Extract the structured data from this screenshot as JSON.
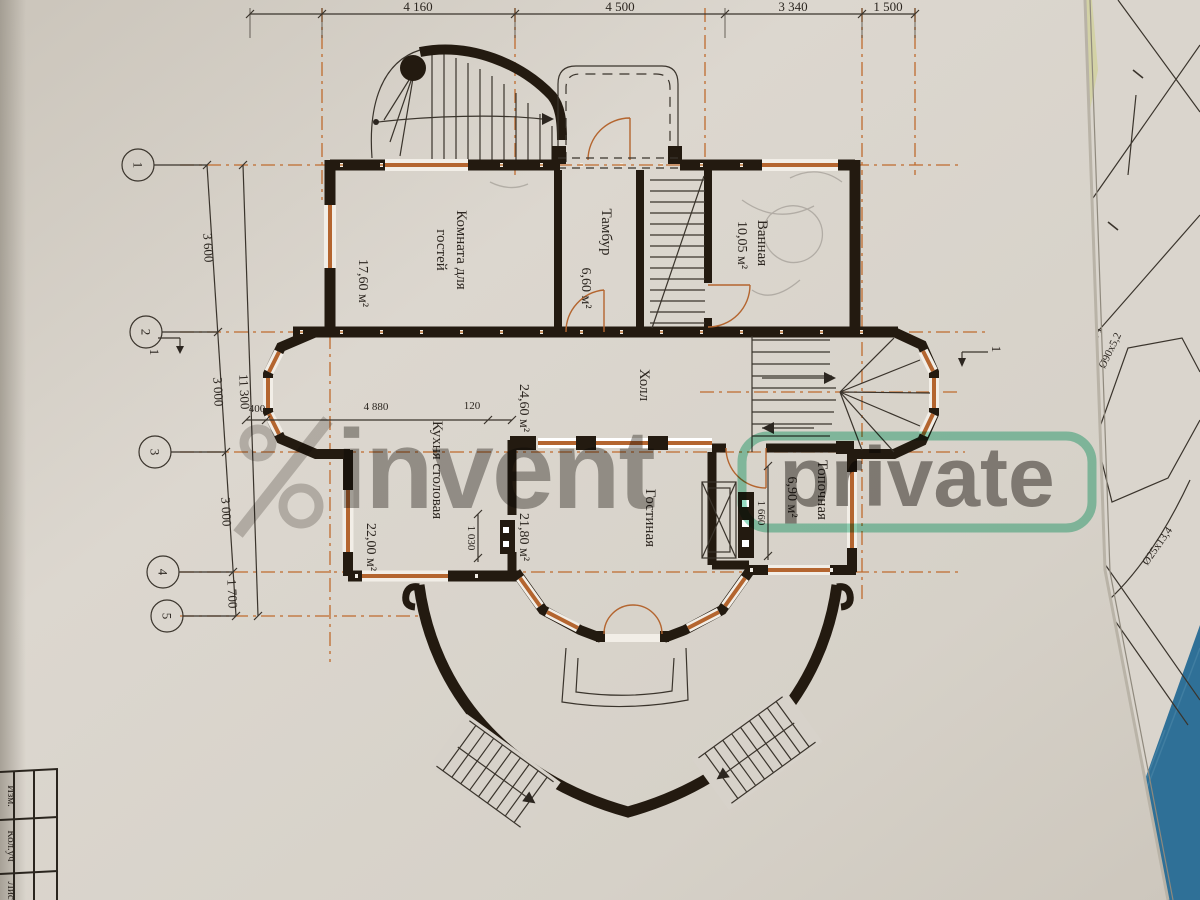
{
  "watermark": {
    "brand": "invent",
    "badge": "private"
  },
  "title_block": {
    "row1": "Изм.",
    "row2": "Кол.уч",
    "row3": "Лист"
  },
  "side_sheet": {
    "pipe1_tag": "Г1",
    "pipe1_size": "Ø90x5,2",
    "pipe2_size": "Ø25x13,4"
  },
  "plan": {
    "grid": {
      "a1": "1",
      "a2": "2",
      "a3": "3",
      "a4": "4",
      "a5": "5"
    },
    "sections": {
      "left": "1",
      "right": "1"
    },
    "rooms": {
      "guest": {
        "line1": "Комната для",
        "line2": "гостей",
        "area": "17,60 м²"
      },
      "tambour": {
        "name": "Тамбур",
        "area": "6,60 м²"
      },
      "bath": {
        "name": "Ванная",
        "area": "10,05 м²"
      },
      "hall": {
        "name": "Холл",
        "area": "24,60 м²"
      },
      "kitchen": {
        "name": "Кухня столовая",
        "area": "22,00 м²"
      },
      "living": {
        "name": "Гостиная",
        "area": "21,80 м²"
      },
      "boiler": {
        "name": "Топочная",
        "area": "6,90 м²"
      }
    },
    "dims": {
      "top1": "4 160",
      "top2": "4 500",
      "top3": "3 340",
      "top4": "1 500",
      "left1": "3 600",
      "left2": "3 000",
      "left3": "3 000",
      "left4": "1 700",
      "left_total": "11 300",
      "d400": "400",
      "d4880": "4 880",
      "d120": "120",
      "d1030": "1 030",
      "d1660": "1 660"
    }
  },
  "colors": {
    "paper": "#d7d2ca",
    "walls": "#231a10",
    "axis_orange": "#bf6b2e",
    "watermark_gray": "#6d6862",
    "watermark_green": "#2eb886",
    "table_blue": "#2f7097"
  }
}
